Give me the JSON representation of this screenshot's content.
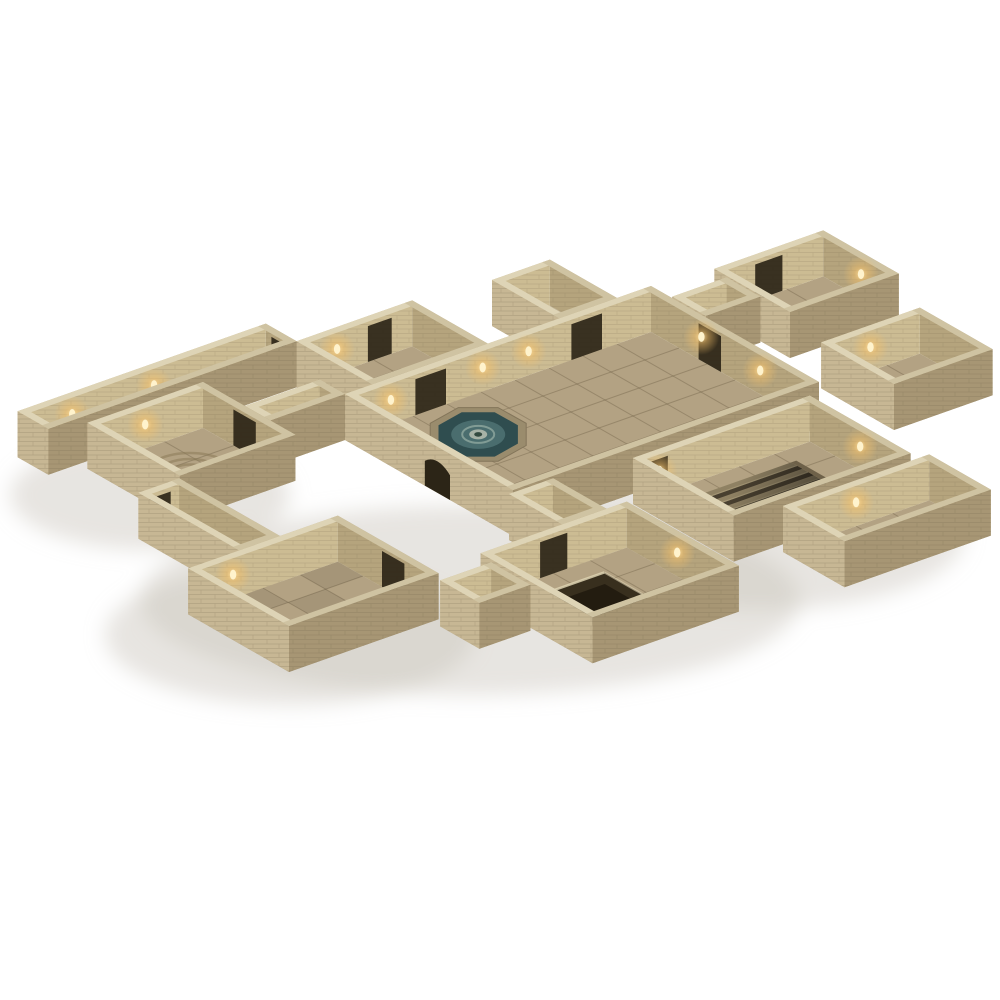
{
  "meta": {
    "description": "Isometric product photo of a modular 3D tabletop dungeon terrain set on a plain white background",
    "subject": "paper-craft stone dungeon rooms with torch-lit walls, central fountain hall, entry stairs, grand sunken staircase, square pit room, ritual circle room, checkered floors and connecting corridors"
  },
  "palette": {
    "background": "#ffffff",
    "shadow": "#c9c5bc",
    "floor": "#b3a283",
    "floor_corridor": "#bfae8e",
    "tile_line": "#6e5f46",
    "wall_interior_lit": "#ccbc93",
    "wall_interior_shade": "#b5a47d",
    "wall_exterior_light": "#c7b794",
    "wall_exterior_dark": "#a79674",
    "wall_cap": "#ded4b6",
    "wall_cap_shade": "#cfc3a2",
    "brick_line": "#6f6148",
    "door_dark": "#2c2517",
    "water_dark": "#2f4d4f",
    "water_mid": "#4a6d6e",
    "water_light": "#8ea79f",
    "stone_rim": "#9a8c6d",
    "torch_glow": "#f3c06a",
    "torch_flame": "#fff3cd",
    "step_base": "#8f8163",
    "step_dark": "#41382a",
    "step_light": "#a89a78",
    "pit_dark": "#382f1e",
    "pit_deep": "#231c10",
    "circle_line": "#8a7a58"
  },
  "scene": {
    "shadows": [
      {
        "cx": 470,
        "cy": 600,
        "rx": 330,
        "ry": 95
      },
      {
        "cx": 290,
        "cy": 635,
        "rx": 185,
        "ry": 70
      },
      {
        "cx": 760,
        "cy": 535,
        "rx": 205,
        "ry": 75
      },
      {
        "cx": 150,
        "cy": 495,
        "rx": 140,
        "ry": 55
      }
    ],
    "rooms": [
      {
        "id": "west-corridor",
        "a": -6.5,
        "b": -3.8,
        "wa": 7.3,
        "wb": 1.1,
        "floor": "floor_corridor",
        "torches": [
          {
            "w": "nw",
            "f": 0.22
          },
          {
            "w": "nw",
            "f": 0.55
          }
        ],
        "doors": [
          {
            "w": "ne",
            "f": 0.5,
            "wd": 0.7
          }
        ]
      },
      {
        "id": "topleft-room",
        "a": 0.8,
        "b": -2.7,
        "wa": 3.4,
        "wb": 2.7,
        "feature": {
          "type": "darkpatch"
        },
        "torches": [
          {
            "w": "nw",
            "f": 0.35
          }
        ],
        "doors": [
          {
            "w": "nw",
            "f": 0.72,
            "wd": 0.7
          }
        ]
      },
      {
        "id": "entry-stairs",
        "a": 6.3,
        "b": -2.4,
        "wa": 1.7,
        "wb": 2.4,
        "feature": {
          "type": "entry-steps"
        }
      },
      {
        "id": "left-room",
        "a": -5.6,
        "b": -2.4,
        "wa": 3.4,
        "wb": 3.3,
        "feature": {
          "type": "circle",
          "ca": -3.9,
          "cb": -0.8
        },
        "torches": [
          {
            "w": "nw",
            "f": 0.5
          }
        ],
        "doors": [
          {
            "w": "ne",
            "f": 0.45,
            "wd": 0.8
          }
        ]
      },
      {
        "id": "left-link",
        "a": -2.2,
        "b": -0.9,
        "wa": 2.2,
        "wb": 0.9,
        "floor": "floor_corridor"
      },
      {
        "id": "great-hall",
        "a": 0,
        "b": 0,
        "wa": 9,
        "wb": 6,
        "feature": {
          "type": "fountain",
          "ca": 2.6,
          "cb": 1.6
        },
        "torches": [
          {
            "w": "nw",
            "f": 0.15
          },
          {
            "w": "nw",
            "f": 0.45
          },
          {
            "w": "nw",
            "f": 0.6
          },
          {
            "w": "ne",
            "f": 0.3
          },
          {
            "w": "ne",
            "f": 0.65
          }
        ],
        "doors": [
          {
            "w": "nw",
            "f": 0.28,
            "wd": 0.9
          },
          {
            "w": "nw",
            "f": 0.79,
            "wd": 0.9
          },
          {
            "w": "ne",
            "f": 0.35,
            "wd": 0.8
          }
        ],
        "extdoors": [
          {
            "w": "sw",
            "f": 0.55,
            "wd": 0.9
          }
        ]
      },
      {
        "id": "ne-corridor",
        "a": 9.05,
        "b": 0.7,
        "wa": 1.6,
        "wb": 1.2,
        "floor": "floor_corridor"
      },
      {
        "id": "topright-room",
        "a": 10.7,
        "b": 0.2,
        "wa": 3.2,
        "wb": 2.7,
        "torches": [
          {
            "w": "ne",
            "f": 0.5
          }
        ],
        "doors": [
          {
            "w": "nw",
            "f": 0.5,
            "wd": 0.8
          }
        ]
      },
      {
        "id": "farright-room",
        "a": 10.3,
        "b": 4.5,
        "wa": 2.9,
        "wb": 2.6,
        "torches": [
          {
            "w": "nw",
            "f": 0.5
          }
        ]
      },
      {
        "id": "stairs-room",
        "a": 3.2,
        "b": 6.4,
        "wa": 5.2,
        "wb": 3.6,
        "feature": {
          "type": "grand-stairs"
        },
        "torches": [
          {
            "w": "ne",
            "f": 0.5
          },
          {
            "w": "nw",
            "f": 0.15
          }
        ],
        "doors": [
          {
            "w": "nw",
            "f": 0.12,
            "wd": 0.8
          }
        ]
      },
      {
        "id": "south-link",
        "a": -0.2,
        "b": 6.1,
        "wa": 1.3,
        "wb": 1.9,
        "floor": "floor_corridor"
      },
      {
        "id": "pit-room",
        "a": -2.6,
        "b": 8.0,
        "wa": 4.3,
        "wb": 4.0,
        "feature": {
          "type": "pit",
          "ca": -0.45,
          "cb": 9.6,
          "half": 0.95
        },
        "torches": [
          {
            "w": "ne",
            "f": 0.45
          }
        ],
        "doors": [
          {
            "w": "nw",
            "f": 0.5,
            "wd": 0.8
          }
        ]
      },
      {
        "id": "bottomright-room",
        "a": 4.4,
        "b": 10.3,
        "wa": 4.3,
        "wb": 2.2,
        "torches": [
          {
            "w": "nw",
            "f": 0.5
          }
        ]
      },
      {
        "id": "bottomleft-room",
        "a": -8.4,
        "b": 4.6,
        "wa": 4.4,
        "wb": 3.6,
        "feature": {
          "type": "checker"
        },
        "torches": [
          {
            "w": "nw",
            "f": 0.3
          }
        ],
        "doors": [
          {
            "w": "ne",
            "f": 0.55,
            "wd": 0.8
          }
        ]
      },
      {
        "id": "sw-corridor",
        "a": -6.9,
        "b": 1.0,
        "wa": 1.2,
        "wb": 3.6,
        "floor": "floor_corridor",
        "doors": [
          {
            "w": "nw",
            "f": 0.5,
            "wd": 0.7
          }
        ]
      },
      {
        "id": "bl-pit-link",
        "a": -4.2,
        "b": 8.5,
        "wa": 1.5,
        "wb": 1.4,
        "floor": "floor_corridor"
      }
    ]
  }
}
